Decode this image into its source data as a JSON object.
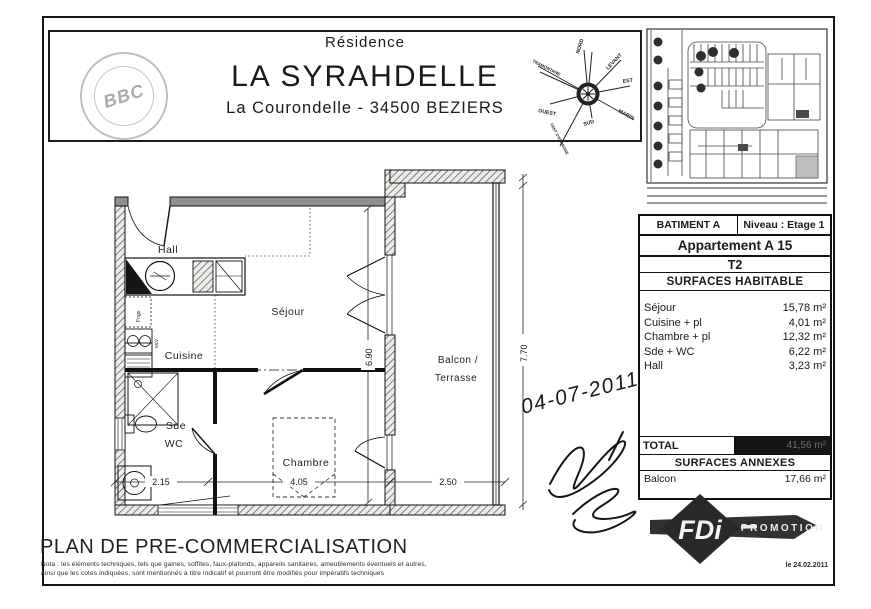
{
  "header": {
    "residence_label": "Résidence",
    "residence_name": "LA SYRAHDELLE",
    "address": "La Courondelle - 34500 BEZIERS",
    "stamp": "BBC"
  },
  "compass": {
    "n": "NORD",
    "ne": "LEVANT",
    "e": "EST",
    "se": "MARIN",
    "s": "SUD",
    "sw": "VENT D'ESPAGNE",
    "w": "OUEST",
    "nw": "TRAMONTANE"
  },
  "info_table": {
    "building": "BATIMENT A",
    "level": "Niveau : Etage 1",
    "apartment": "Appartement A 15",
    "type": "T2",
    "surfaces_title": "SURFACES HABITABLE",
    "rows": [
      {
        "label": "Séjour",
        "value": "15,78 m²"
      },
      {
        "label": "Cuisine + pl",
        "value": "4,01 m²"
      },
      {
        "label": "Chambre + pl",
        "value": "12,32 m²"
      },
      {
        "label": "Sde + WC",
        "value": "6,22 m²"
      },
      {
        "label": "Hall",
        "value": "3,23 m²"
      }
    ],
    "total_label": "TOTAL",
    "total_value": "41,56 m²",
    "annexes_title": "SURFACES ANNEXES",
    "annexe_label": "Balcon",
    "annexe_value": "17,66 m²"
  },
  "floor_plan": {
    "rooms": {
      "hall": "Hall",
      "sejour": "Séjour",
      "cuisine": "Cuisine",
      "sde": "Sde",
      "wc": "WC",
      "chambre": "Chambre",
      "balcon_line1": "Balcon /",
      "balcon_line2": "Terrasse"
    },
    "dimensions": {
      "sejour_depth": "6.90",
      "facade_height": "7.70",
      "sde_width": "2.15",
      "chambre_width": "4.05",
      "balcon_width": "2.50"
    },
    "fixtures": {
      "fridge": "Frigo",
      "sink": "MLV"
    }
  },
  "signature": {
    "date": "04-07-2011"
  },
  "logo": {
    "brand": "FDi",
    "tagline": "PROMOTION",
    "issue_date": "le 24.02.2011"
  },
  "footer": {
    "title": "PLAN DE PRE-COMMERCIALISATION",
    "note1": "Nota : les éléments techniques, tels que gaines, soffites, faux-plafonds, appareils sanitaires, ameublements éventuels et autres,",
    "note2": "ainsi que les cotes indiquées, sont mentionnés à titre indicatif et pourront être modifiés pour impératifs techniques"
  }
}
